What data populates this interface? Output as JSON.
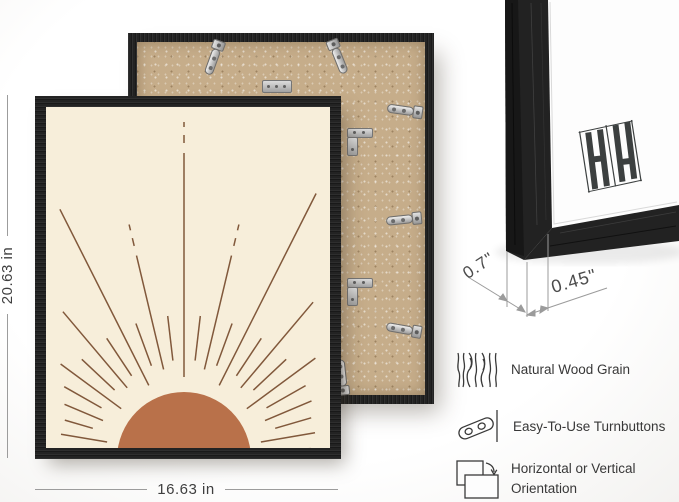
{
  "dimensions": {
    "height_label": "20.63 in",
    "width_label": "16.63 in",
    "depth_label": "0.7\"",
    "face_label": "0.45\""
  },
  "features": [
    {
      "icon": "wood-grain-icon",
      "label": "Natural Wood Grain"
    },
    {
      "icon": "turnbutton-icon",
      "label": "Easy-To-Use Turnbuttons"
    },
    {
      "icon": "orientation-icon",
      "label": "Horizontal or Vertical Orientation"
    }
  ],
  "colors": {
    "frame": "#232323",
    "backing": "#c6ad8a",
    "art_background": "#f7eeda",
    "ray": "#7b5133",
    "sun": "#b9714a",
    "mat": "#fdfdfd",
    "dimension": "#9c9c9c",
    "text": "#3f3f3f",
    "metal": "#c9c9c9"
  }
}
